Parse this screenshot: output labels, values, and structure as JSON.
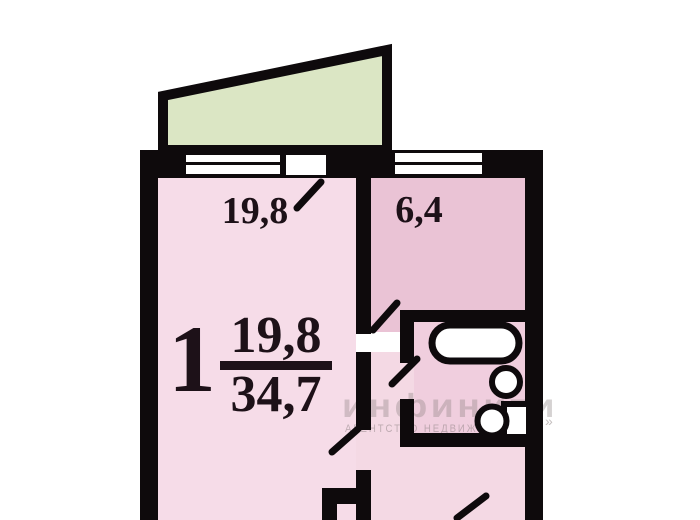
{
  "document": {
    "kind": "apartment-floor-plan",
    "rooms": "1-room flat with balcony, kitchen, bathroom and hallway"
  },
  "labels": {
    "living_room_area": "19,8",
    "kitchen_area": "6,4",
    "room_count": "1",
    "living_area": "19,8",
    "total_area": "34,7"
  },
  "watermark": {
    "brand": "инфинити",
    "tagline": "агентство недвижимости",
    "arrow": "»"
  },
  "colors": {
    "wall": "#0e0a0c",
    "living_room_fill": "#f6dce8",
    "kitchen_fill": "#eac3d5",
    "bathroom_fill": "#f0cede",
    "hallway_fill": "#f4d9e4",
    "balcony_fill": "#dbe6c4",
    "window_fill": "#ffffff",
    "label_text": "#1d1118",
    "watermark_text": "#8a7f7f",
    "background": "#ffffff"
  }
}
